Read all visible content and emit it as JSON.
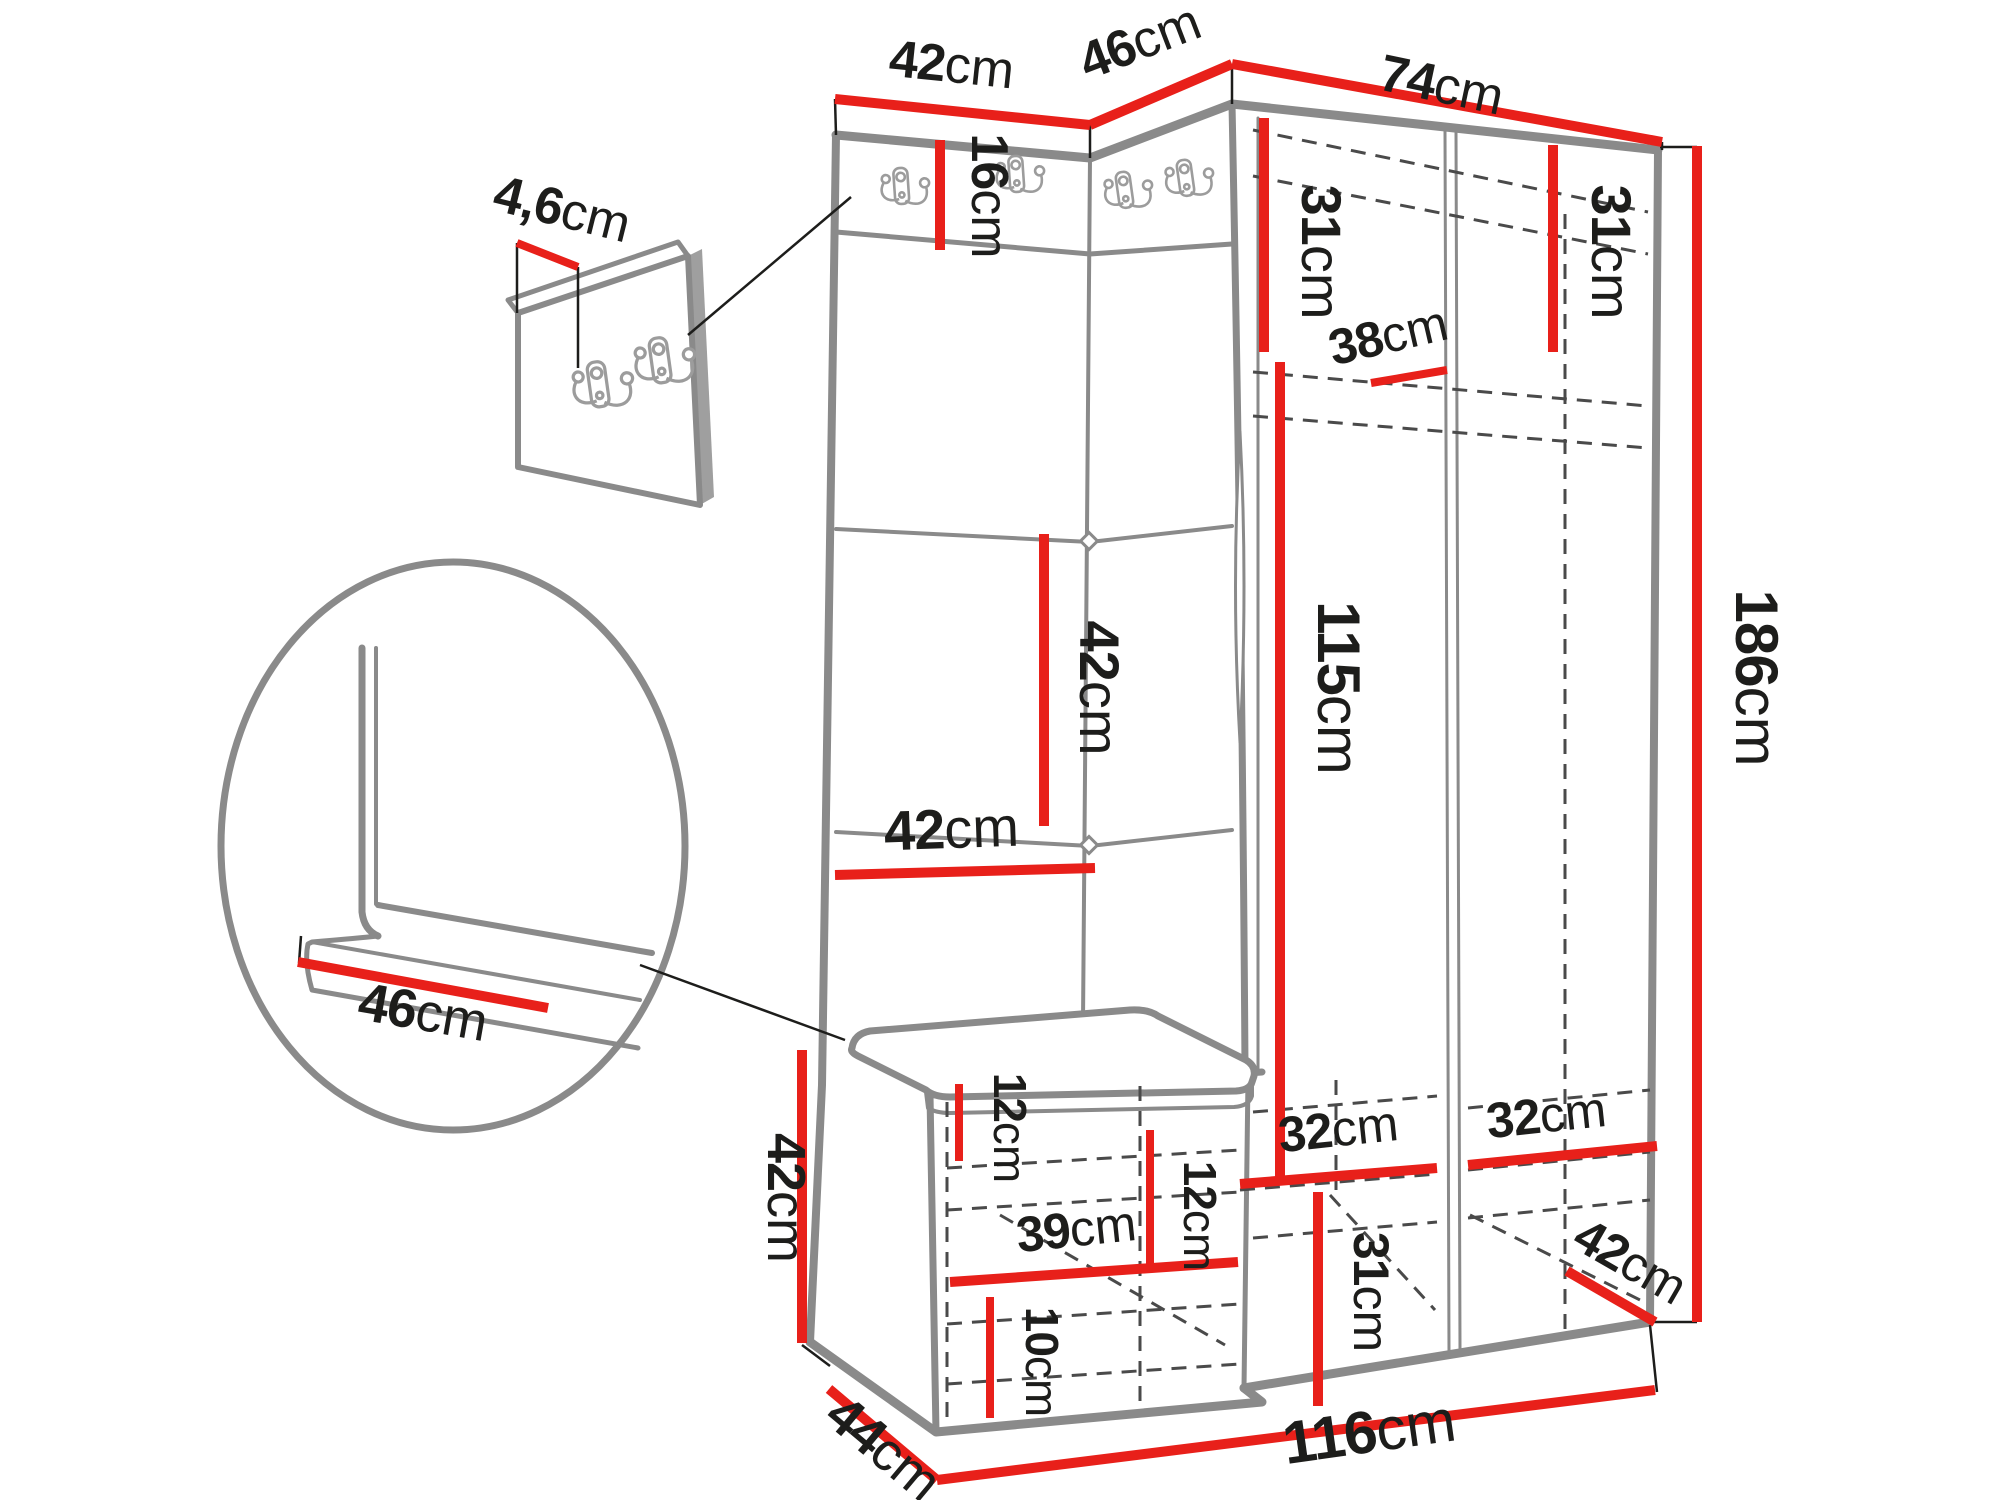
{
  "drawing": {
    "type": "furniture-dimension-diagram",
    "subject": "corner hallway wardrobe set with coat hooks, bench and shoe cabinet",
    "unit": "cm",
    "hook_count_main_panel": 4,
    "hook_count_detail_panel": 2
  },
  "colors": {
    "dimension_line": "#e8201a",
    "outline": "#8a8a8a",
    "hidden_edge": "#4a4a4a",
    "text": "#1d1d1b",
    "background": "#ffffff"
  },
  "dims": {
    "top_42": {
      "value": "42",
      "unit": "cm"
    },
    "top_46": {
      "value": "46",
      "unit": "cm"
    },
    "top_74": {
      "value": "74",
      "unit": "cm"
    },
    "panel_4_6": {
      "value": "4,6",
      "unit": "cm"
    },
    "hook_16": {
      "value": "16",
      "unit": "cm"
    },
    "left_31": {
      "value": "31",
      "unit": "cm"
    },
    "right_31": {
      "value": "31",
      "unit": "cm"
    },
    "shelf_38": {
      "value": "38",
      "unit": "cm"
    },
    "panel_42_v": {
      "value": "42",
      "unit": "cm"
    },
    "panel_42_h": {
      "value": "42",
      "unit": "cm"
    },
    "interior_115": {
      "value": "115",
      "unit": "cm"
    },
    "height_186": {
      "value": "186",
      "unit": "cm"
    },
    "seat_46": {
      "value": "46",
      "unit": "cm"
    },
    "bench_42": {
      "value": "42",
      "unit": "cm"
    },
    "bench_12_left": {
      "value": "12",
      "unit": "cm"
    },
    "bench_39": {
      "value": "39",
      "unit": "cm"
    },
    "bench_12_right": {
      "value": "12",
      "unit": "cm"
    },
    "bench_10": {
      "value": "10",
      "unit": "cm"
    },
    "bottom_31": {
      "value": "31",
      "unit": "cm"
    },
    "comp_32_left": {
      "value": "32",
      "unit": "cm"
    },
    "comp_32_right": {
      "value": "32",
      "unit": "cm"
    },
    "br_42": {
      "value": "42",
      "unit": "cm"
    },
    "depth_44": {
      "value": "44",
      "unit": "cm"
    },
    "width_116": {
      "value": "116",
      "unit": "cm"
    }
  }
}
